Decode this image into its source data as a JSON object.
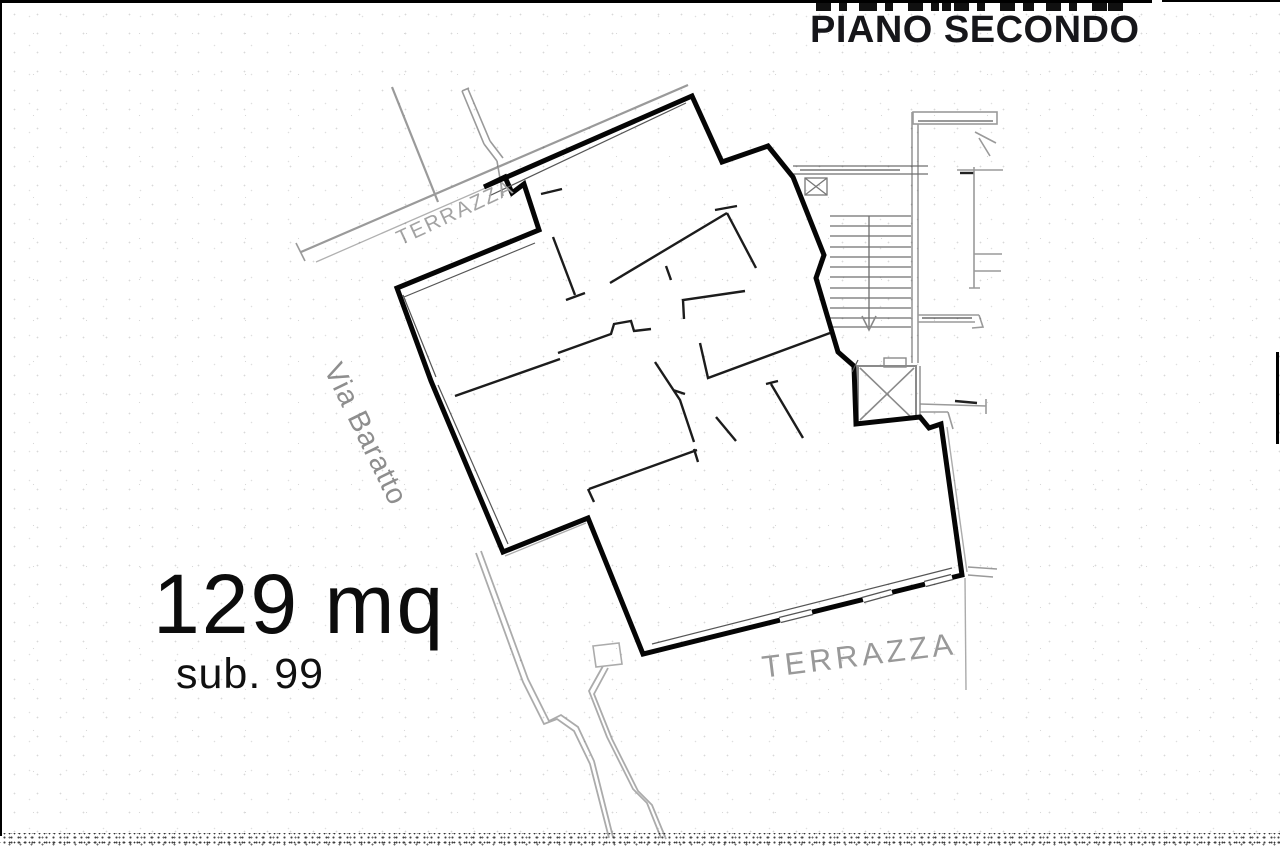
{
  "meta": {
    "drawing_type": "cadastral floor plan",
    "floor": "second floor"
  },
  "header": {
    "title": "PIANO SECONDO"
  },
  "labels": {
    "area": "129 mq",
    "sub": "sub. 99",
    "street": "Via Baratto",
    "terrace_small": "TERRAZZA",
    "terrace_large": "TERRAZZA"
  },
  "colors": {
    "background": "#ffffff",
    "outer_wall": "#050505",
    "interior_wall": "#1c1c1c",
    "ancillary_gray": "#9a9a9a",
    "label_gray": "#989898",
    "title_color": "#16161a"
  }
}
